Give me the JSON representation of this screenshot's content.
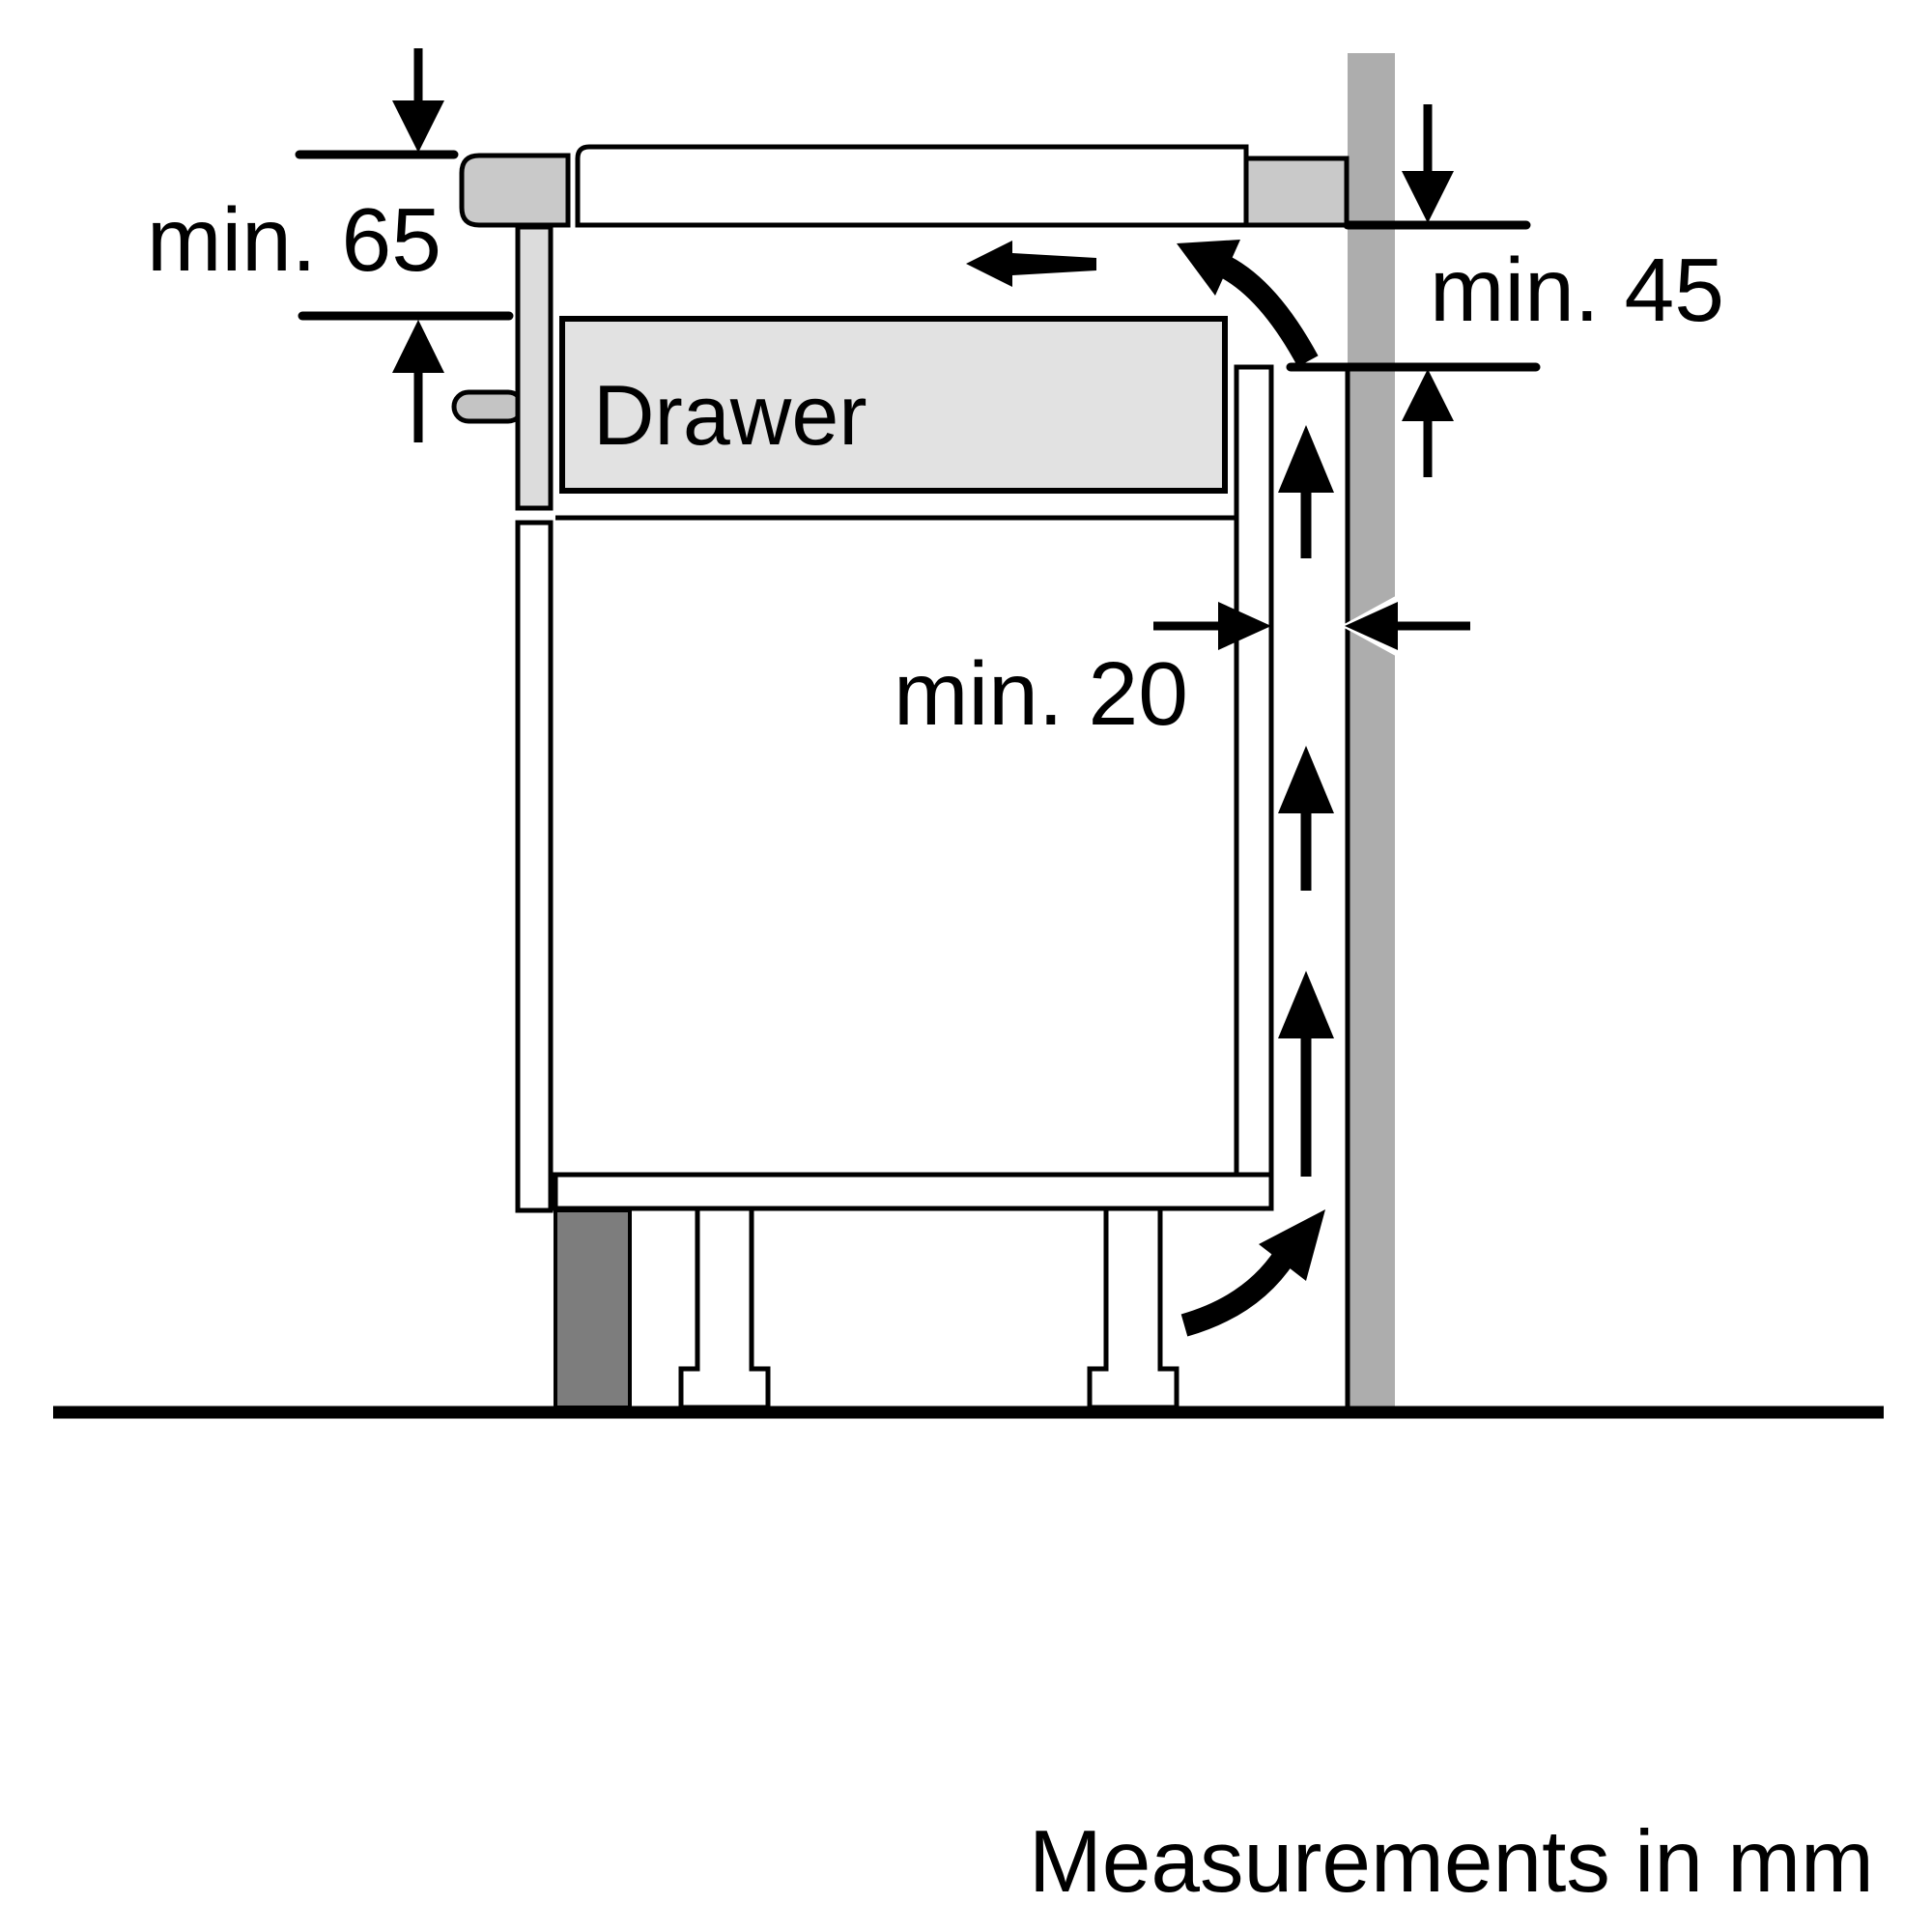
{
  "diagram": {
    "labels": {
      "clearance_hob_to_drawer": "min. 65",
      "clearance_worktop_to_vent": "min. 45",
      "clearance_back_gap": "min. 20",
      "drawer": "Drawer",
      "footnote": "Measurements in mm"
    },
    "values_mm": {
      "hob_top_to_drawer_min": 65,
      "worktop_bottom_to_vent_opening_min": 45,
      "cabinet_back_to_wall_gap_min": 20
    },
    "colors": {
      "background": "#ffffff",
      "outline": "#000000",
      "wall": "#adadad",
      "worktop_end": "#c9c9c9",
      "hob_lip": "#c9c9c9",
      "drawer_body": "#e2e2e2",
      "drawer_front": "#dcdcdc",
      "handle": "#c4c4c4",
      "plinth": "#7d7d7d"
    }
  }
}
